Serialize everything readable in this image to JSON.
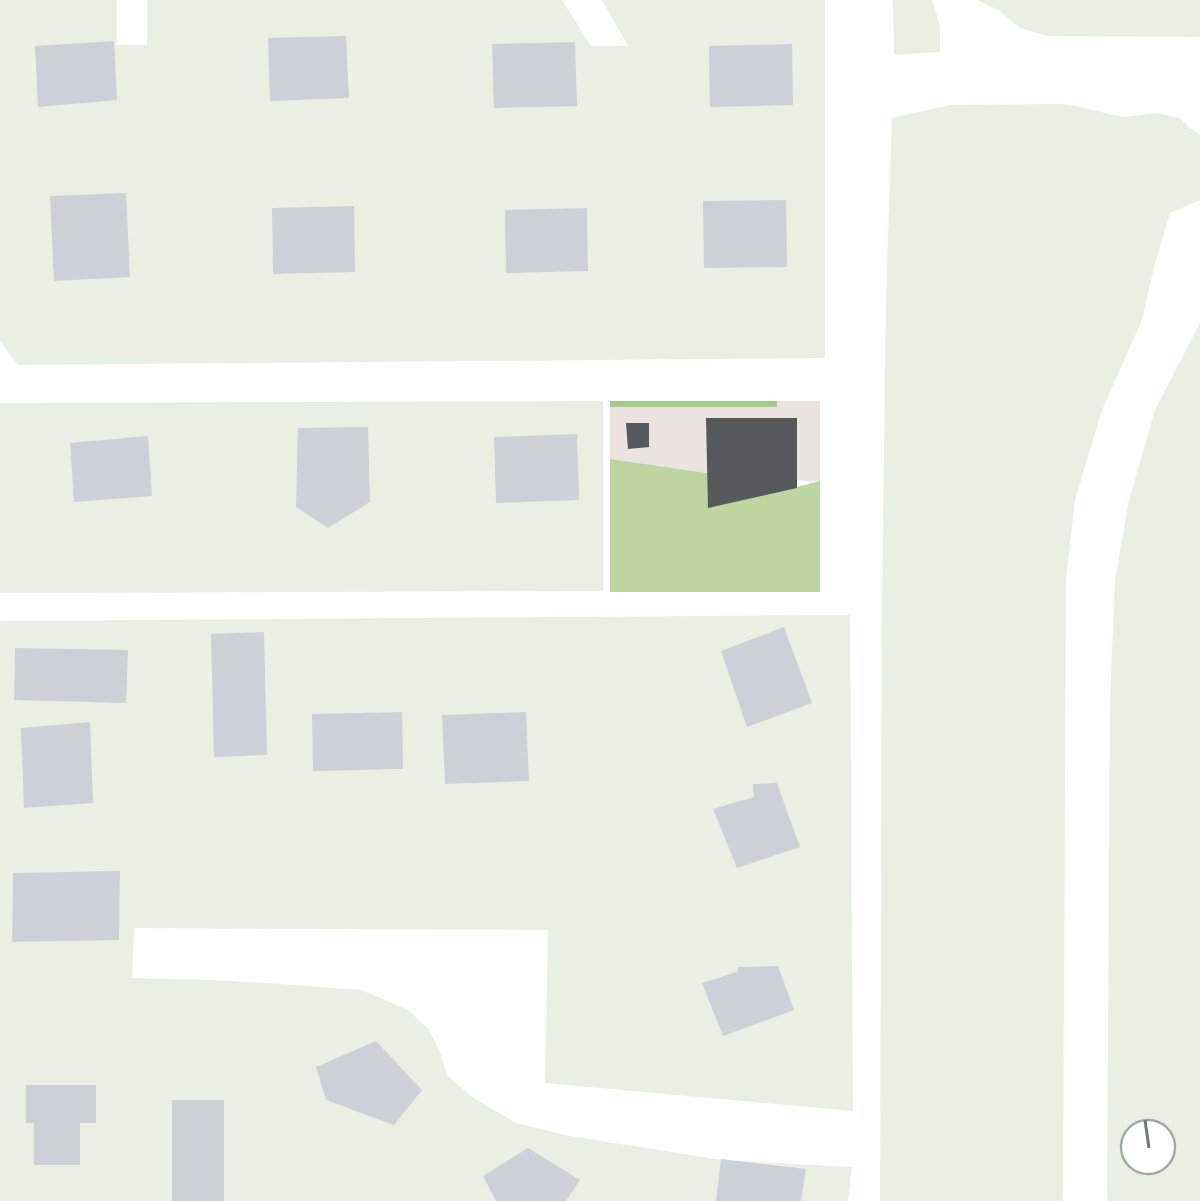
{
  "map": {
    "canvas": {
      "width": 1200,
      "height": 1201,
      "background": "#ffffff"
    },
    "colors": {
      "road": "#ffffff",
      "block": "#e9efe2",
      "building": "#ccd1d8",
      "site_paving": "#eae3e0",
      "site_lawn": "#bdd6a1",
      "site_hedge": "#a7ca8c",
      "site_building": "#55595c",
      "compass_ring": "#a3a9a9",
      "compass_needle": "#6f7779"
    },
    "blocks": [
      {
        "name": "city-block-northwest",
        "points": [
          [
            0,
            0
          ],
          [
            117,
            0
          ],
          [
            117,
            45
          ],
          [
            147,
            45
          ],
          [
            147,
            0
          ],
          [
            562,
            0
          ],
          [
            591,
            46
          ],
          [
            628,
            46
          ],
          [
            602,
            0
          ],
          [
            825,
            0
          ],
          [
            825,
            358
          ],
          [
            18,
            365
          ],
          [
            0,
            341
          ]
        ]
      },
      {
        "name": "city-block-west",
        "points": [
          [
            0,
            403
          ],
          [
            603,
            401
          ],
          [
            603,
            591
          ],
          [
            0,
            593
          ]
        ]
      },
      {
        "name": "city-block-south",
        "points": [
          [
            0,
            621
          ],
          [
            850,
            615
          ],
          [
            853,
            1111
          ],
          [
            545,
            1083
          ],
          [
            548,
            930
          ],
          [
            134,
            928
          ],
          [
            132,
            978
          ],
          [
            212,
            980
          ],
          [
            266,
            983
          ],
          [
            362,
            990
          ],
          [
            408,
            1010
          ],
          [
            428,
            1028
          ],
          [
            440,
            1052
          ],
          [
            447,
            1075
          ],
          [
            472,
            1097
          ],
          [
            516,
            1123
          ],
          [
            570,
            1136
          ],
          [
            722,
            1160
          ],
          [
            852,
            1167
          ],
          [
            848,
            1201
          ],
          [
            0,
            1201
          ]
        ]
      },
      {
        "name": "city-block-east",
        "points": [
          [
            892,
            118
          ],
          [
            950,
            105
          ],
          [
            1060,
            104
          ],
          [
            1075,
            106
          ],
          [
            1123,
            117
          ],
          [
            1157,
            113
          ],
          [
            1180,
            118
          ],
          [
            1190,
            128
          ],
          [
            1200,
            135
          ],
          [
            1200,
            200
          ],
          [
            1170,
            213
          ],
          [
            1155,
            263
          ],
          [
            1142,
            320
          ],
          [
            1102,
            410
          ],
          [
            1075,
            500
          ],
          [
            1066,
            580
          ],
          [
            1063,
            1201
          ],
          [
            880,
            1201
          ],
          [
            882,
            600
          ],
          [
            886,
            300
          ]
        ]
      },
      {
        "name": "city-block-east-edge",
        "points": [
          [
            1200,
            323
          ],
          [
            1155,
            410
          ],
          [
            1129,
            500
          ],
          [
            1115,
            580
          ],
          [
            1110,
            700
          ],
          [
            1107,
            1201
          ],
          [
            1200,
            1201
          ]
        ]
      },
      {
        "name": "verge-top-right",
        "points": [
          [
            977,
            0
          ],
          [
            1000,
            11
          ],
          [
            1020,
            28
          ],
          [
            1048,
            36
          ],
          [
            1200,
            37
          ],
          [
            1200,
            0
          ]
        ]
      },
      {
        "name": "verge-top-center",
        "points": [
          [
            893,
            0
          ],
          [
            932,
            0
          ],
          [
            940,
            25
          ],
          [
            940,
            52
          ],
          [
            894,
            55
          ]
        ]
      }
    ],
    "site": {
      "paving": {
        "name": "site-paving",
        "points": [
          [
            610,
            401
          ],
          [
            820,
            401
          ],
          [
            820,
            482
          ],
          [
            700,
            472
          ],
          [
            610,
            459
          ]
        ]
      },
      "hedge": {
        "name": "site-hedge-strip",
        "points": [
          [
            610,
            401
          ],
          [
            777,
            401
          ],
          [
            777,
            407
          ],
          [
            610,
            407
          ]
        ]
      },
      "lawn": {
        "name": "site-lawn",
        "points": [
          [
            610,
            459
          ],
          [
            700,
            472
          ],
          [
            797,
            487
          ],
          [
            820,
            481
          ],
          [
            820,
            592
          ],
          [
            610,
            592
          ]
        ]
      },
      "buildings": [
        {
          "name": "site-main-building",
          "points": [
            [
              706,
              418
            ],
            [
              797,
              418
            ],
            [
              797,
              488
            ],
            [
              708,
              508
            ]
          ]
        },
        {
          "name": "site-annex-building",
          "points": [
            [
              626,
              423
            ],
            [
              649,
              423
            ],
            [
              649,
              447
            ],
            [
              628,
              449
            ]
          ]
        }
      ]
    },
    "neighbor_buildings": [
      {
        "name": "building-nw-r1-1",
        "points": [
          [
            35,
            46
          ],
          [
            114,
            41
          ],
          [
            117,
            100
          ],
          [
            38,
            107
          ]
        ]
      },
      {
        "name": "building-nw-r1-2",
        "points": [
          [
            268,
            38
          ],
          [
            346,
            36
          ],
          [
            349,
            98
          ],
          [
            270,
            101
          ]
        ]
      },
      {
        "name": "building-nw-r1-3",
        "points": [
          [
            492,
            44
          ],
          [
            575,
            42
          ],
          [
            577,
            106
          ],
          [
            494,
            108
          ]
        ]
      },
      {
        "name": "building-nw-r1-4",
        "points": [
          [
            709,
            46
          ],
          [
            792,
            44
          ],
          [
            793,
            105
          ],
          [
            710,
            107
          ]
        ]
      },
      {
        "name": "building-nw-r2-1",
        "points": [
          [
            50,
            196
          ],
          [
            126,
            193
          ],
          [
            130,
            277
          ],
          [
            54,
            281
          ]
        ]
      },
      {
        "name": "building-nw-r2-2",
        "points": [
          [
            272,
            208
          ],
          [
            354,
            206
          ],
          [
            355,
            272
          ],
          [
            273,
            274
          ]
        ]
      },
      {
        "name": "building-nw-r2-3",
        "points": [
          [
            505,
            210
          ],
          [
            587,
            208
          ],
          [
            588,
            271
          ],
          [
            506,
            273
          ]
        ]
      },
      {
        "name": "building-nw-r2-4",
        "points": [
          [
            703,
            201
          ],
          [
            786,
            200
          ],
          [
            787,
            267
          ],
          [
            704,
            268
          ]
        ]
      },
      {
        "name": "building-west-1",
        "points": [
          [
            70,
            443
          ],
          [
            148,
            436
          ],
          [
            152,
            496
          ],
          [
            74,
            502
          ]
        ]
      },
      {
        "name": "building-west-2",
        "points": [
          [
            298,
            428
          ],
          [
            368,
            427
          ],
          [
            370,
            502
          ],
          [
            328,
            528
          ],
          [
            296,
            507
          ]
        ]
      },
      {
        "name": "building-west-3",
        "points": [
          [
            494,
            437
          ],
          [
            577,
            434
          ],
          [
            579,
            500
          ],
          [
            496,
            503
          ]
        ]
      },
      {
        "name": "building-south-1",
        "points": [
          [
            15,
            648
          ],
          [
            128,
            650
          ],
          [
            126,
            703
          ],
          [
            14,
            700
          ]
        ]
      },
      {
        "name": "building-south-2",
        "points": [
          [
            211,
            634
          ],
          [
            264,
            632
          ],
          [
            267,
            755
          ],
          [
            214,
            757
          ]
        ]
      },
      {
        "name": "building-south-3",
        "points": [
          [
            21,
            728
          ],
          [
            90,
            722
          ],
          [
            93,
            803
          ],
          [
            24,
            808
          ]
        ]
      },
      {
        "name": "building-south-4",
        "points": [
          [
            312,
            714
          ],
          [
            402,
            712
          ],
          [
            403,
            769
          ],
          [
            313,
            771
          ]
        ]
      },
      {
        "name": "building-south-5",
        "points": [
          [
            442,
            715
          ],
          [
            526,
            712
          ],
          [
            529,
            781
          ],
          [
            445,
            784
          ]
        ]
      },
      {
        "name": "building-south-6",
        "points": [
          [
            13,
            873
          ],
          [
            120,
            871
          ],
          [
            119,
            940
          ],
          [
            12,
            942
          ]
        ]
      },
      {
        "name": "building-mid-1",
        "points": [
          [
            721,
            651
          ],
          [
            784,
            627
          ],
          [
            812,
            703
          ],
          [
            747,
            727
          ]
        ]
      },
      {
        "name": "building-mid-2",
        "points": [
          [
            713,
            809
          ],
          [
            754,
            797
          ],
          [
            753,
            784
          ],
          [
            777,
            783
          ],
          [
            800,
            847
          ],
          [
            737,
            868
          ]
        ]
      },
      {
        "name": "building-mid-3",
        "points": [
          [
            702,
            983
          ],
          [
            737,
            972
          ],
          [
            738,
            967
          ],
          [
            778,
            966
          ],
          [
            794,
            1010
          ],
          [
            723,
            1036
          ]
        ]
      },
      {
        "name": "building-sw-1",
        "points": [
          [
            26,
            1085
          ],
          [
            96,
            1085
          ],
          [
            96,
            1123
          ],
          [
            80,
            1123
          ],
          [
            80,
            1165
          ],
          [
            34,
            1165
          ],
          [
            34,
            1123
          ],
          [
            26,
            1123
          ]
        ]
      },
      {
        "name": "building-sw-2",
        "points": [
          [
            172,
            1100
          ],
          [
            224,
            1100
          ],
          [
            224,
            1201
          ],
          [
            172,
            1201
          ]
        ]
      },
      {
        "name": "building-sw-3",
        "points": [
          [
            316,
            1067
          ],
          [
            376,
            1041
          ],
          [
            422,
            1090
          ],
          [
            394,
            1125
          ],
          [
            326,
            1100
          ]
        ]
      },
      {
        "name": "building-sw-4",
        "points": [
          [
            528,
            1148
          ],
          [
            580,
            1180
          ],
          [
            566,
            1201
          ],
          [
            496,
            1201
          ],
          [
            483,
            1176
          ]
        ]
      },
      {
        "name": "building-sw-5",
        "points": [
          [
            721,
            1159
          ],
          [
            806,
            1169
          ],
          [
            801,
            1201
          ],
          [
            716,
            1201
          ]
        ]
      }
    ],
    "compass": {
      "cx": 1148,
      "cy": 1147,
      "r": 27,
      "ring_width": 2.4,
      "needle": {
        "x1": 1145,
        "y1": 1120,
        "x2": 1149,
        "y2": 1148,
        "width": 3
      }
    }
  }
}
